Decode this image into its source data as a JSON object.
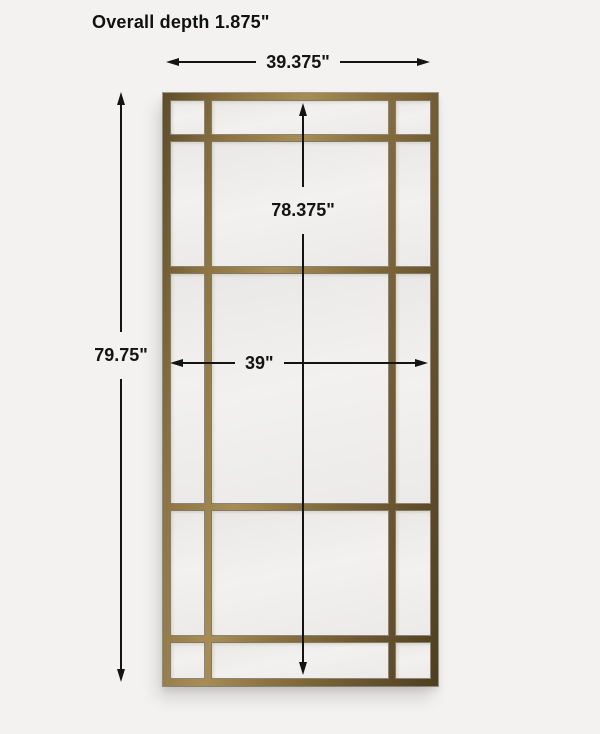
{
  "canvas": {
    "background": "#f3f2f0"
  },
  "title": {
    "text": "Overall depth 1.875\""
  },
  "dimensions": {
    "line_color": "#141414",
    "top_width": {
      "label": "39.375\""
    },
    "overall_height": {
      "label": "79.75\""
    },
    "inner_height": {
      "label": "78.375\""
    },
    "inner_width": {
      "label": "39\""
    }
  },
  "mirror": {
    "description": "paneled window-pane floor mirror, 3 columns x 5 rows grid",
    "frame_colors": {
      "dark": "#4e3f20",
      "base": "#8b7240",
      "light": "#a78d55"
    },
    "pane_color": "#efeeec",
    "grid": {
      "columns": 3,
      "rows": 5
    }
  }
}
